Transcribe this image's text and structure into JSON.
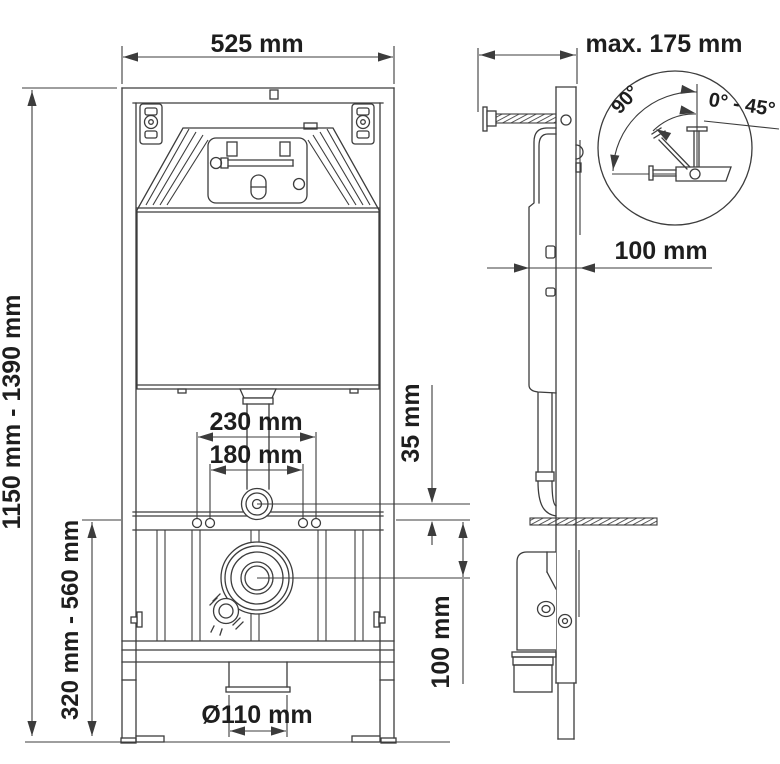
{
  "labels": {
    "front": {
      "width": "525 mm",
      "height_range": "1150 mm - 1390 mm",
      "bowl_height_range": "320 mm - 560 mm",
      "stud_spacing_outer": "230 mm",
      "stud_spacing_inner": "180 mm",
      "supply_offset": "35 mm",
      "drain_offset": "100 mm",
      "drain_diameter": "Ø110 mm"
    },
    "side": {
      "max_depth": "max. 175 mm",
      "wall_clearance": "100 mm",
      "angle_perpendicular": "90°",
      "angle_range": "0° - 45°"
    }
  },
  "colors": {
    "line": "#3c3c3c",
    "ink": "#1e1e1e",
    "bg": "#ffffff"
  }
}
